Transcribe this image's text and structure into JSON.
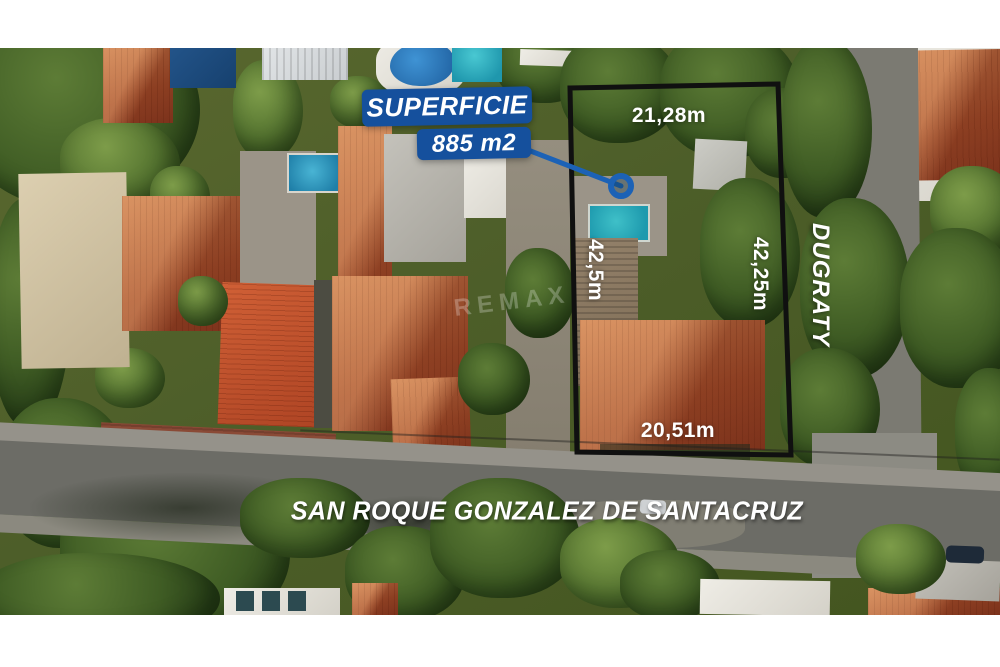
{
  "overlay": {
    "area_label": {
      "title": "SUPERFICIE",
      "value": "885 m2"
    },
    "measurements": {
      "top": "21,28m",
      "left": "42,5m",
      "right": "42,25m",
      "bottom": "20,51m"
    },
    "streets": {
      "right_vertical": "DUGRATY",
      "bottom_horizontal": "SAN ROQUE GONZALEZ DE SANTACRUZ"
    },
    "watermark": "REMAX",
    "colors": {
      "label_background": "#15509d",
      "leader_line": "#1c62b6",
      "boundary": "#101010",
      "text": "#ffffff"
    }
  }
}
